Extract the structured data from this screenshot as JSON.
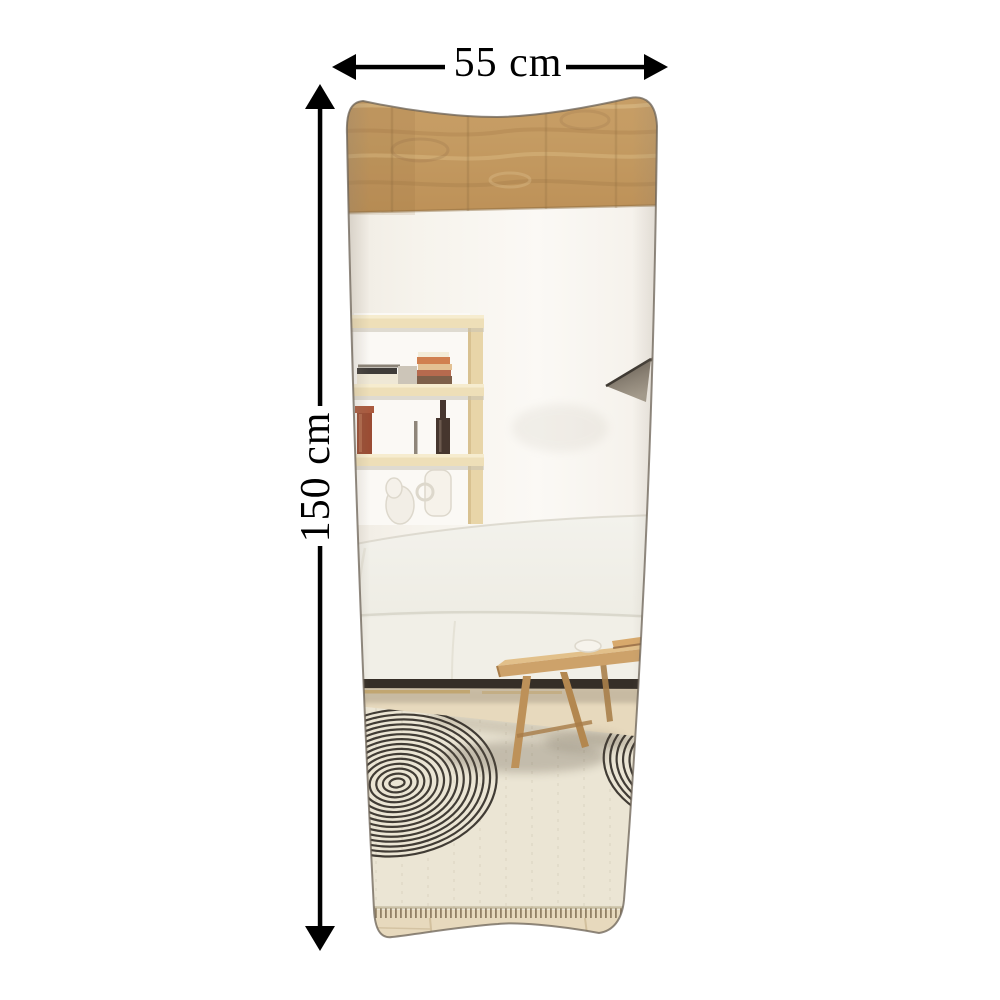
{
  "image": {
    "kind": "product-dimension-photo",
    "subject": "wavy full-length wall mirror reflecting a living room",
    "background_color": "#ffffff"
  },
  "dimensions": {
    "width": {
      "label": "55 cm",
      "value": 55,
      "unit": "cm"
    },
    "height": {
      "label": "150 cm",
      "value": 150,
      "unit": "cm"
    },
    "arrow_color": "#000000",
    "text_color": "#000000"
  },
  "scene": {
    "objects": [
      "wood-ceiling",
      "white-wall",
      "built-in-shelf-niche",
      "stacked-books",
      "red-vase",
      "dark-bottle",
      "white-jug-and-sculpture",
      "wall-lamp-shade",
      "white-curved-sofa",
      "wooden-coffee-table",
      "patterned-area-rug",
      "wood-floor"
    ]
  },
  "palette": {
    "wood_ceiling": "#c59c63",
    "wall": "#f6f3ec",
    "shelf_wood": "#ecdcb4",
    "sofa": "#f1efe8",
    "sofa_base": "#352e27",
    "table_wood": "#cda26a",
    "rug": "#ebe5d4",
    "rug_pattern": "#2f2a24",
    "floor": "#e9dabb",
    "mirror_edge": "#6b6155"
  }
}
